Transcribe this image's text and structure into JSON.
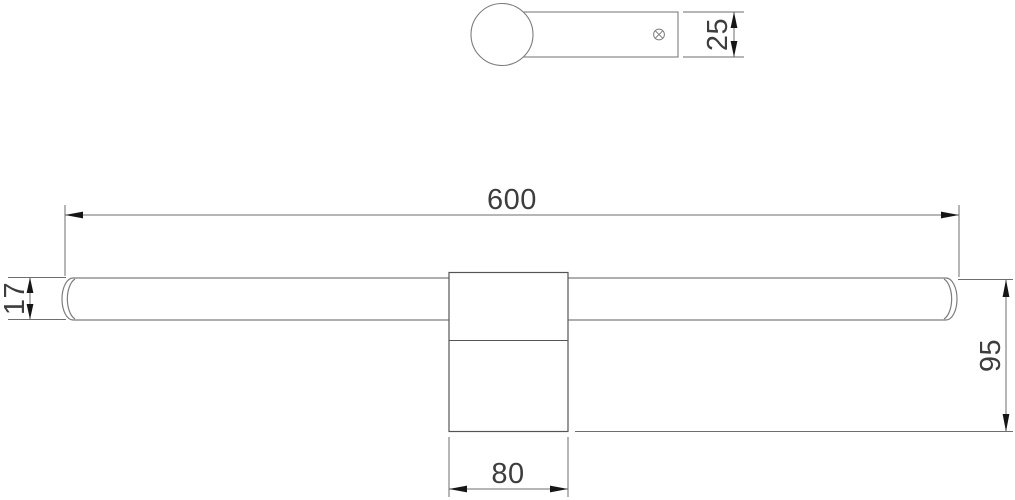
{
  "colors": {
    "bg": "#ffffff",
    "tube_line": "#7d7d7d",
    "bracket_line": "#555555",
    "dim_line": "#6e6e6e",
    "arrow": "#161616",
    "text": "#3d3d3d"
  },
  "views": {
    "side_profile": {
      "description": "side profile of wall light: round tube end over mounting arm",
      "screw_icon": "screw-cross-icon"
    },
    "front": {
      "description": "front view: long tube with central wall bracket"
    }
  },
  "dimensions": {
    "arm_depth": {
      "value": "25"
    },
    "overall_length": {
      "value": "600"
    },
    "tube_diameter": {
      "value": "17"
    },
    "overall_height": {
      "value": "95"
    },
    "bracket_width": {
      "value": "80"
    }
  }
}
